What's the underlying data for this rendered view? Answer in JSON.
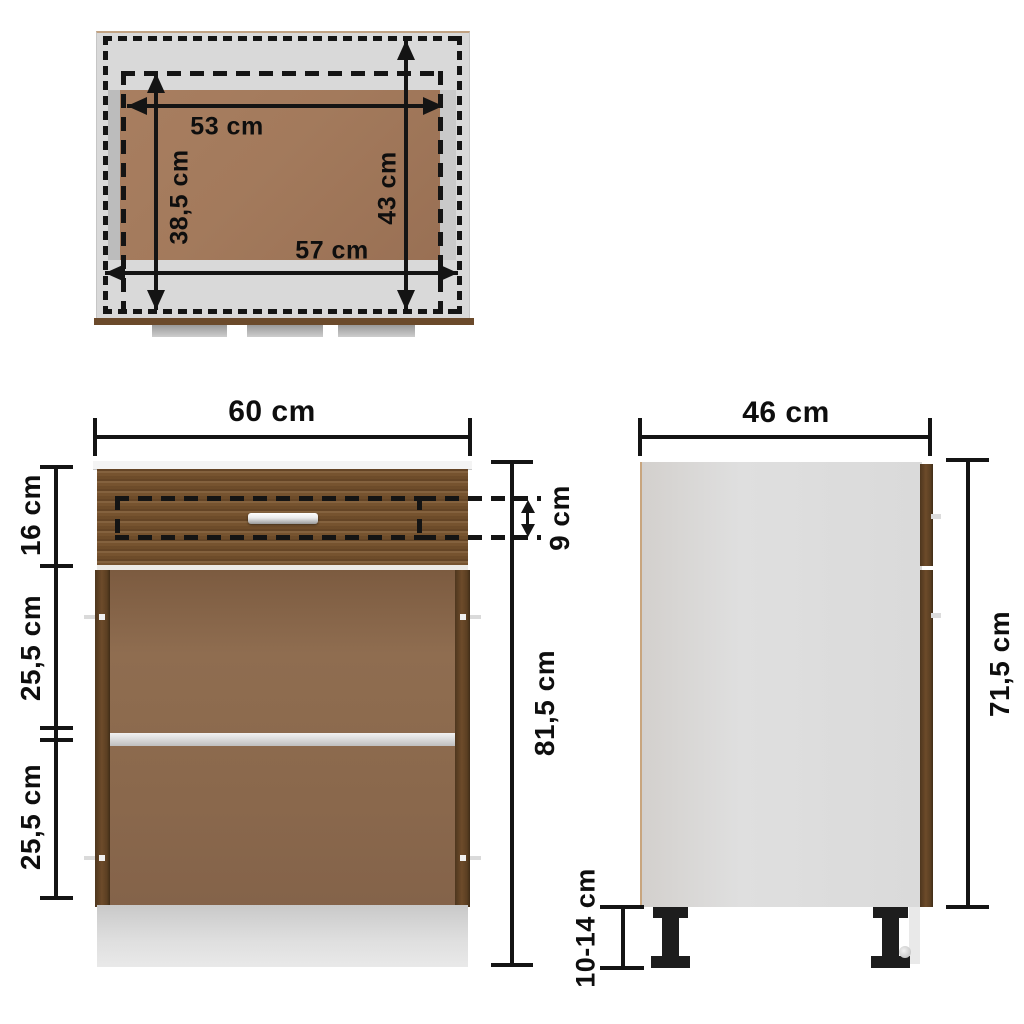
{
  "views": {
    "top": {
      "dims": {
        "inner_width": "53 cm",
        "inner_depth": "38,5 cm",
        "outer_width": "57 cm",
        "outer_depth": "43 cm"
      }
    },
    "front": {
      "dims": {
        "width": "60 cm",
        "drawer_front_height": "16 cm",
        "upper_compartment": "25,5 cm",
        "lower_compartment": "25,5 cm",
        "drawer_inner_height": "9 cm",
        "total_height": "81,5 cm"
      }
    },
    "side": {
      "dims": {
        "depth": "46 cm",
        "body_height": "71,5 cm",
        "leg_height": "10-14 cm"
      }
    }
  },
  "colors": {
    "dimension_lines": "#141414",
    "wood_front": "#76532f",
    "wood_edge_dark": "#5b3f22",
    "interior_brown": "#8a684c",
    "top_view_brown": "#a37a5c",
    "panel_gray": "#dcdcdc",
    "plinth_gray": "#d6d6d6",
    "worktop_edge_brown": "#6b4a2b",
    "leg_black": "#1d1d1d",
    "background": "#ffffff"
  }
}
